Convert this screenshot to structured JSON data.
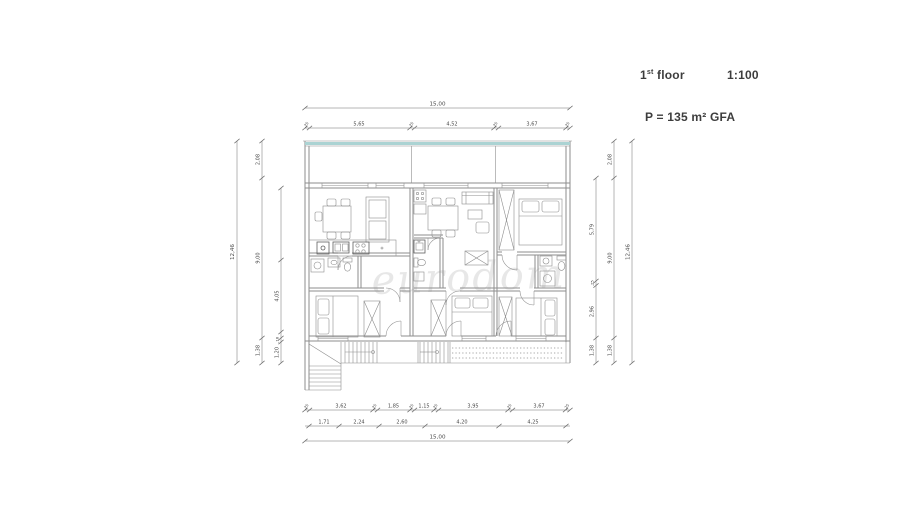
{
  "header": {
    "floor_num": "1",
    "floor_sup": "st",
    "floor_word": "floor",
    "scale": "1:100",
    "area": "P = 135 m² GFA"
  },
  "watermark": "eurodom",
  "dims": {
    "wall": ",25",
    "top": {
      "total": "15,00",
      "segments": [
        "5,65",
        "4,52",
        "3,67"
      ]
    },
    "bottom": {
      "row1": [
        "3,62",
        "1,85",
        "1,15",
        "3,95",
        "3,67"
      ],
      "row2": [
        "1,71",
        "2,24",
        "2,60",
        "4,20",
        "4,25"
      ],
      "total": "15,00"
    },
    "left": {
      "outer": "12,46",
      "mid": [
        "2,08",
        "9,00",
        "1,38"
      ],
      "inner": [
        "4,05",
        ",18",
        "1,20"
      ]
    },
    "right": {
      "outer": "12,46",
      "mid": [
        "2,08",
        "9,00",
        "1,38"
      ],
      "inner": [
        "5,79",
        ",25",
        "2,96",
        "1,38"
      ]
    }
  },
  "colors": {
    "line": "#8e8e8e",
    "dim": "#6e6e6e",
    "glass": "#abd3d3",
    "watermark": "#d8d8d8"
  }
}
